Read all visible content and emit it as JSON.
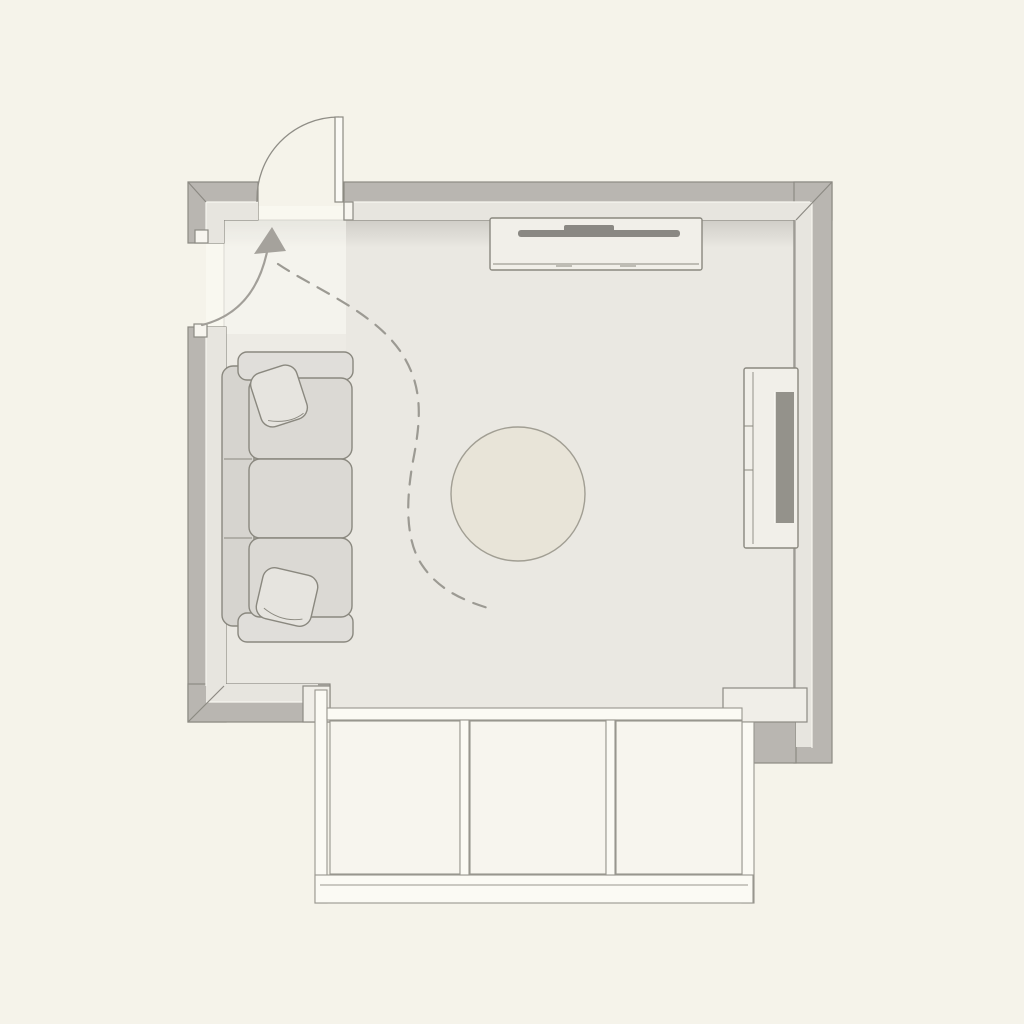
{
  "scene": {
    "type": "floor-plan",
    "view": "top-down",
    "room": {
      "shape": "rectangular room with bay-window bump-out at bottom",
      "door": {
        "location": "top wall, left corner",
        "state": "open",
        "swing": "outward quarter-circle arc"
      },
      "side_opening": {
        "location": "left wall, below top-left corner"
      }
    },
    "furniture": [
      {
        "name": "sofa",
        "position": "against left wall",
        "seat_cushions": 3,
        "throw_pillows": 2
      },
      {
        "name": "round-rug",
        "position": "room center"
      },
      {
        "name": "media-console",
        "position": "against top wall",
        "holds": "flat tv panel"
      },
      {
        "name": "tv-unit",
        "position": "against right wall",
        "detail": "recessed dark screen strip"
      },
      {
        "name": "bay-window",
        "position": "bottom wall",
        "panes": 3
      }
    ],
    "annotations": [
      {
        "name": "entry-arrow",
        "style": "solid curved arrow pointing toward door"
      },
      {
        "name": "walk-path",
        "style": "dashed S-curve from entry past sofa toward bay window"
      }
    ]
  },
  "colors": {
    "background": "#f5f3ea",
    "floor": "#eae8e2",
    "entry_light": "rgba(253,252,247,0.45)",
    "wall": "#b9b6b1",
    "wall_bevel": "#e7e5df",
    "wall_cap": "#f0eee8",
    "door_stop": "#f7f5ef",
    "window_frame": "#fbfaf4",
    "window_pane": "#f7f5ee",
    "cabinet": "#f1efe9",
    "tv": "#8a8883",
    "unit_screen": "#94928b",
    "sofa": "#dbd9d4",
    "sofa_back": "#d6d4cf",
    "sofa_arm": "#e0deda",
    "pillow": "#e6e4df",
    "rug": "#e8e4d8",
    "door": "#fbfaf6",
    "arrow": "#a5a29c"
  }
}
